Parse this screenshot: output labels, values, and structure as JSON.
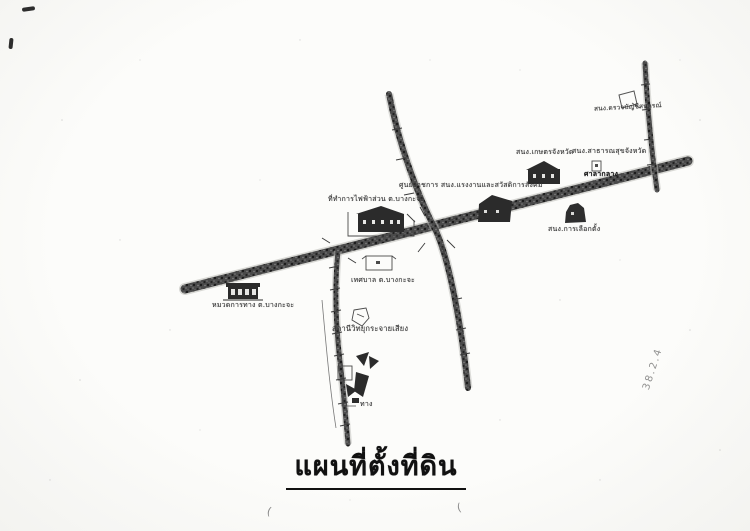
{
  "page": {
    "title": "แผนที่ตั้งที่ดิน"
  },
  "map": {
    "labels": {
      "coop_audit_office": "สนง.ตรวจบัญชีสหกรณ์",
      "agriculture_office": "สนง.เกษตรจังหวัด",
      "public_health_office": "สนง.สาธารณสุขจังหวัด",
      "provincial_hall": "ศาลากลาง",
      "government_center": "ศูนย์ราชการ สนง.แรงงานและสวัสดิการสังคม",
      "election_office": "สนง.การเลือกตั้ง",
      "electricity_office": "ที่ทำการไฟฟ้าส่วน ต.บางกะจะ",
      "municipality": "เทศบาล ต.บางกะจะ",
      "radio_station": "สถานีวิทยุกระจายเสียง",
      "highway_office": "หมวดการทาง ต.บางกะจะ",
      "path_label": "ทาง",
      "handwritten_note": "38.2.4"
    }
  }
}
